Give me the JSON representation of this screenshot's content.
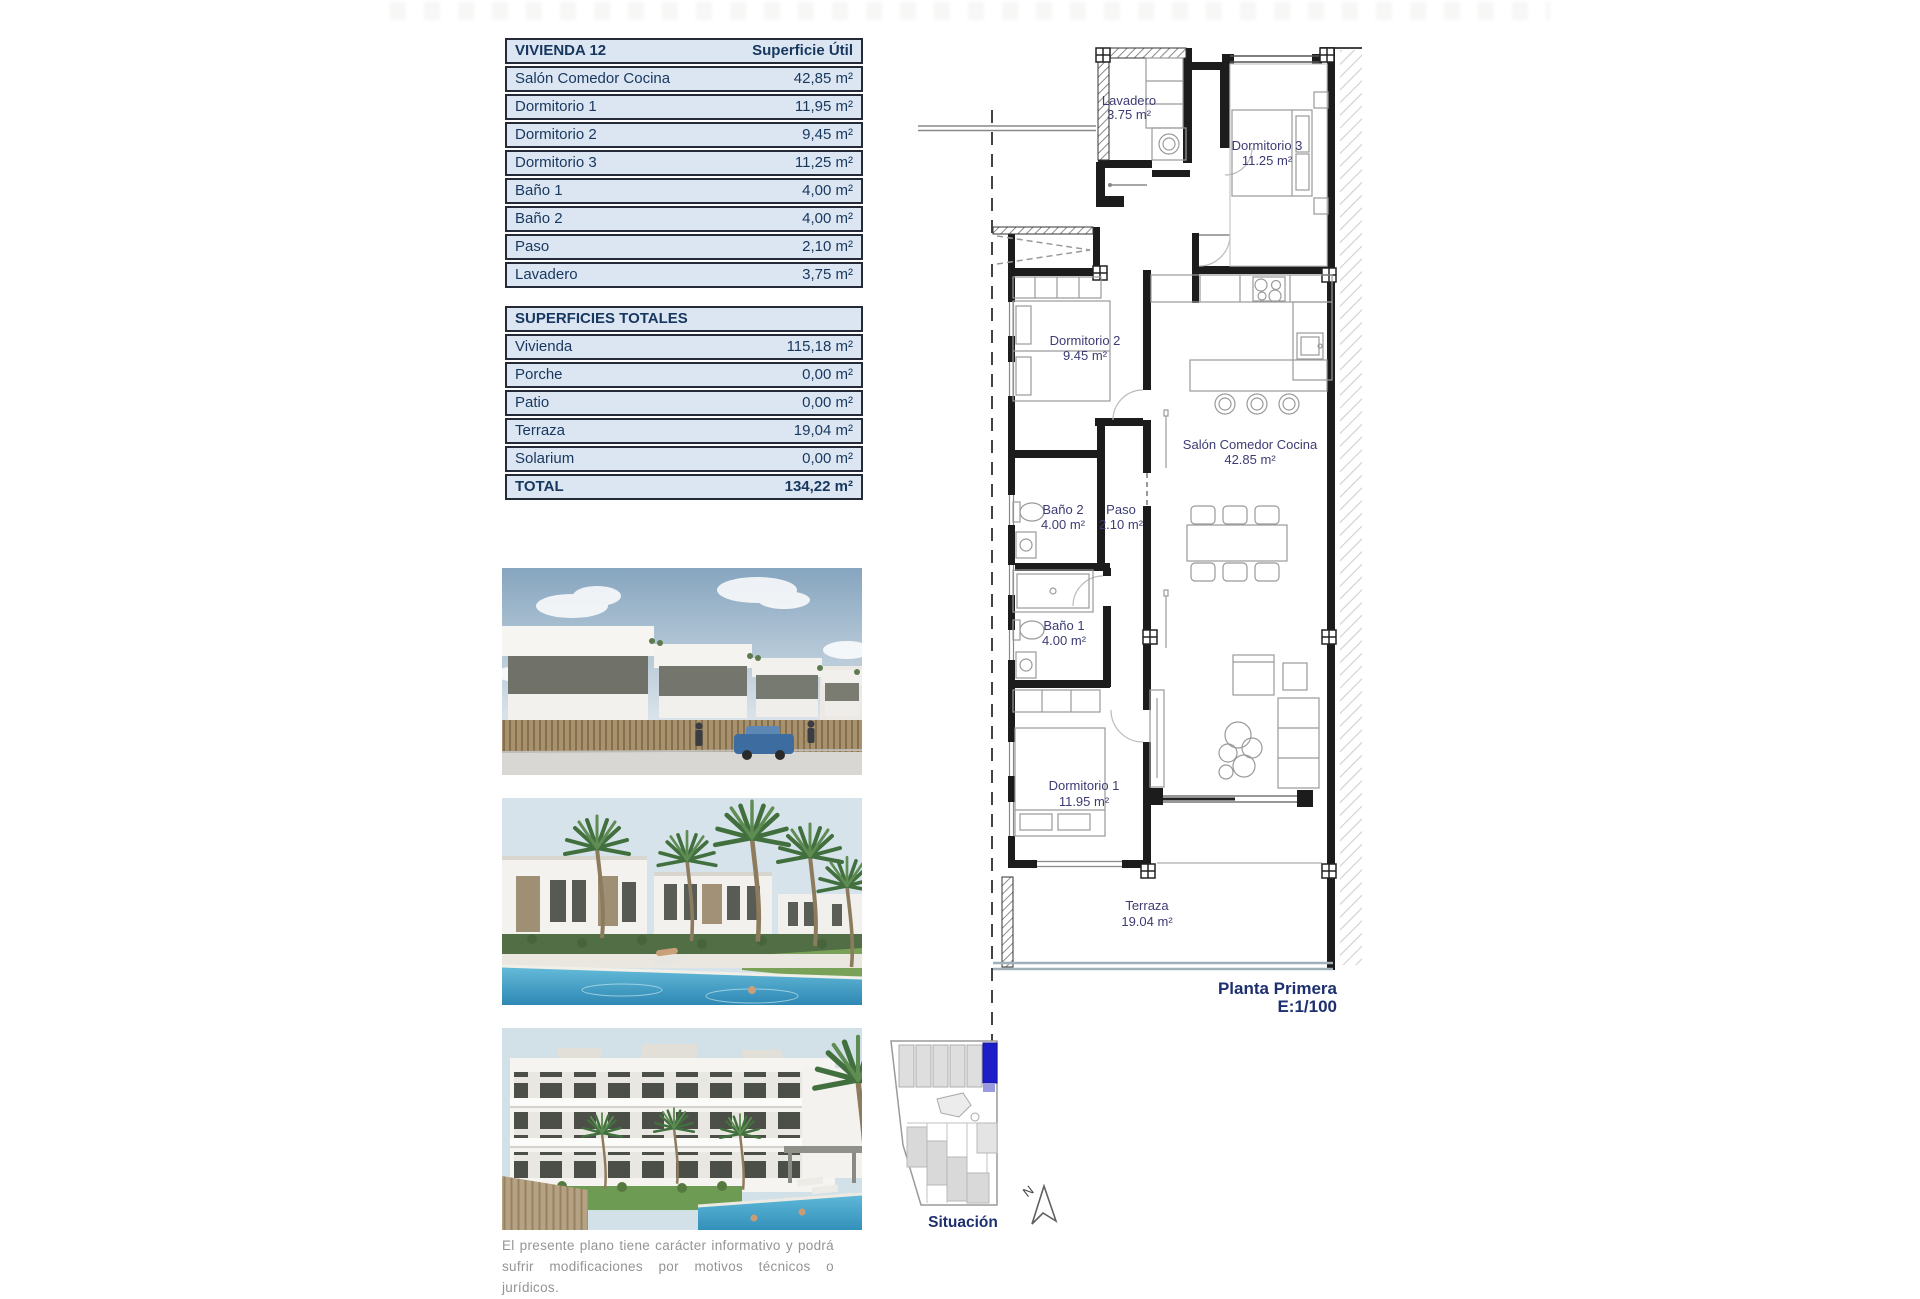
{
  "vivienda_table": {
    "title": "VIVIENDA 12",
    "header_right": "Superficie Útil",
    "rows": [
      {
        "label": "Salón Comedor Cocina",
        "value": "42,85 m²"
      },
      {
        "label": "Dormitorio 1",
        "value": "11,95 m²"
      },
      {
        "label": "Dormitorio 2",
        "value": "9,45 m²"
      },
      {
        "label": "Dormitorio 3",
        "value": "11,25 m²"
      },
      {
        "label": "Baño 1",
        "value": "4,00 m²"
      },
      {
        "label": "Baño 2",
        "value": "4,00 m²"
      },
      {
        "label": "Paso",
        "value": "2,10 m²"
      },
      {
        "label": "Lavadero",
        "value": "3,75 m²"
      }
    ]
  },
  "totales_table": {
    "title": "SUPERFICIES TOTALES",
    "rows": [
      {
        "label": "Vivienda",
        "value": "115,18 m²"
      },
      {
        "label": "Porche",
        "value": "0,00 m²"
      },
      {
        "label": "Patio",
        "value": "0,00 m²"
      },
      {
        "label": "Terraza",
        "value": "19,04 m²"
      },
      {
        "label": "Solarium",
        "value": "0,00 m²"
      }
    ],
    "total": {
      "label": "TOTAL",
      "value": "134,22 m²"
    }
  },
  "plan": {
    "rooms": {
      "lavadero": {
        "name": "Lavadero",
        "area": "3.75 m²"
      },
      "dormitorio3": {
        "name": "Dormitorio 3",
        "area": "11.25 m²"
      },
      "dormitorio2": {
        "name": "Dormitorio 2",
        "area": "9.45 m²"
      },
      "salon": {
        "name": "Salón Comedor Cocina",
        "area": "42.85 m²"
      },
      "bano2": {
        "name": "Baño 2",
        "area": "4.00 m²"
      },
      "paso": {
        "name": "Paso",
        "area": "2.10 m²"
      },
      "bano1": {
        "name": "Baño 1",
        "area": "4.00 m²"
      },
      "dormitorio1": {
        "name": "Dormitorio 1",
        "area": "11.95 m²"
      },
      "terraza": {
        "name": "Terraza",
        "area": "19.04 m²"
      }
    },
    "caption": "Planta Primera",
    "scale": "E:1/100"
  },
  "situacion": {
    "label": "Situación",
    "north": "N"
  },
  "disclaimer": "El presente plano tiene carácter informativo y podrá sufrir modificaciones por motivos técnicos o jurídicos.",
  "colors": {
    "navy_text": "#17375e",
    "table_fill": "#dce6f2",
    "table_border": "#242a36",
    "plan_label": "#3c3c74",
    "caption_navy": "#1d2f6e",
    "highlight_blue": "#1e1ec8",
    "terrace_edge": "#9fb0b8",
    "pool_blue": "#3390ba"
  }
}
